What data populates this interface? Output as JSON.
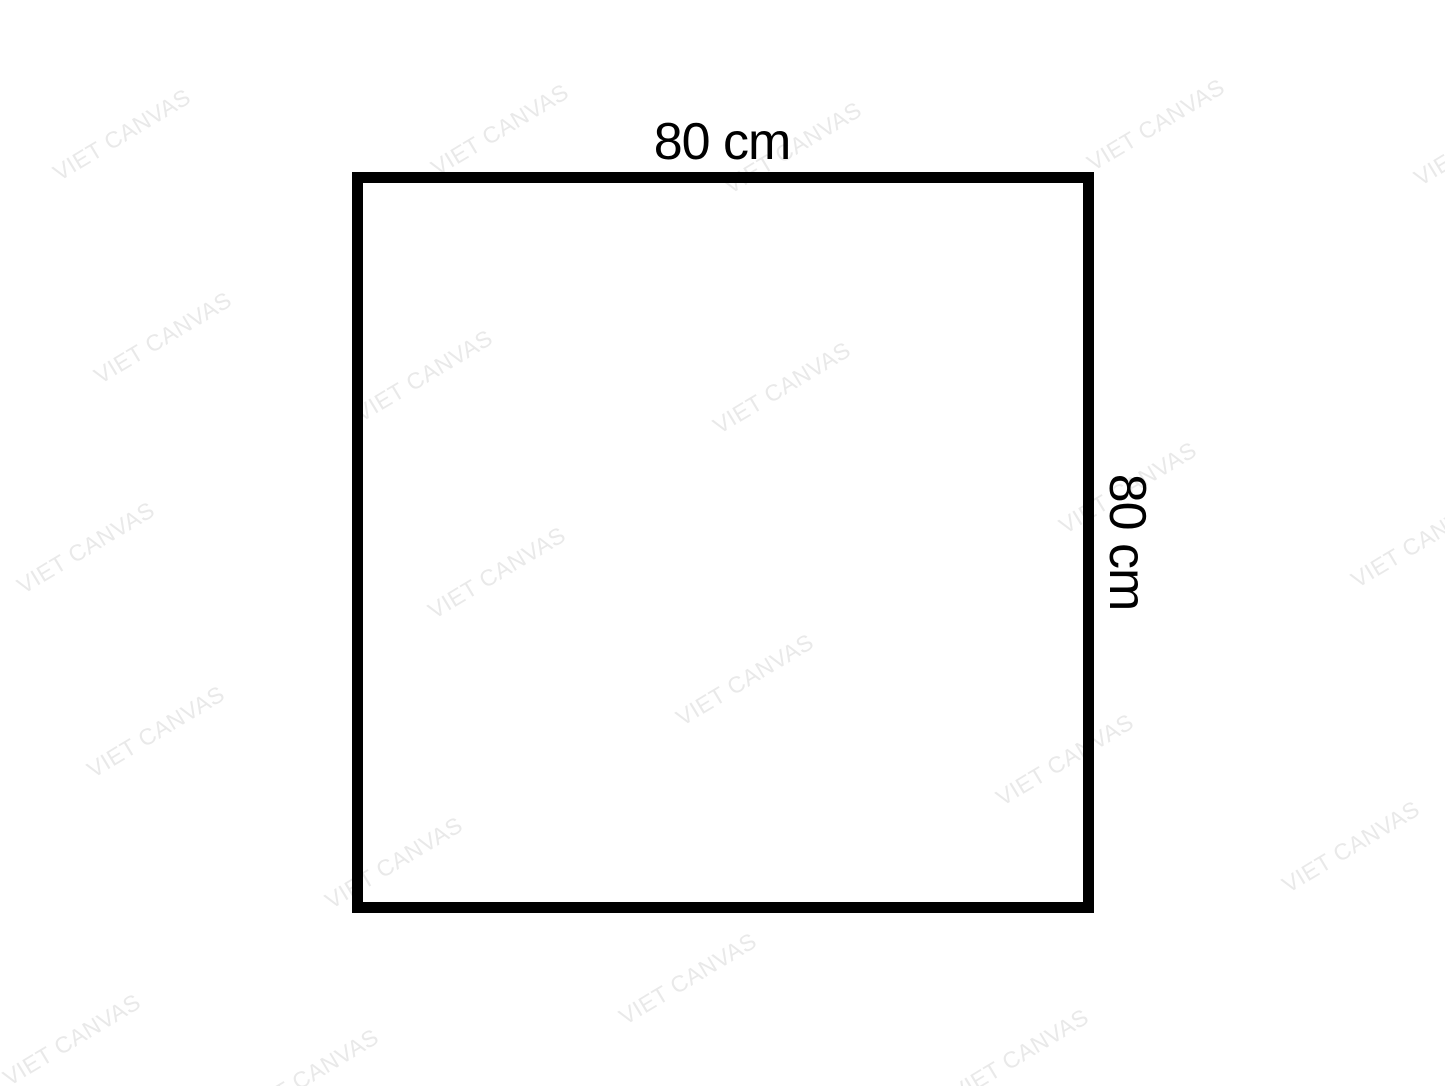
{
  "diagram": {
    "shape": "square",
    "width_label": "80 cm",
    "height_label": "80 cm"
  },
  "watermark": {
    "text": "VIET CANVAS",
    "color": "#e9e9e9",
    "angle_deg": -31,
    "positions": [
      {
        "x": 122,
        "y": 135
      },
      {
        "x": 500,
        "y": 130
      },
      {
        "x": 793,
        "y": 148
      },
      {
        "x": 1156,
        "y": 125
      },
      {
        "x": 1483,
        "y": 140
      },
      {
        "x": 163,
        "y": 338
      },
      {
        "x": 424,
        "y": 376
      },
      {
        "x": 782,
        "y": 388
      },
      {
        "x": 1128,
        "y": 488
      },
      {
        "x": 86,
        "y": 548
      },
      {
        "x": 497,
        "y": 573
      },
      {
        "x": 1420,
        "y": 542
      },
      {
        "x": 745,
        "y": 680
      },
      {
        "x": 156,
        "y": 732
      },
      {
        "x": 1065,
        "y": 760
      },
      {
        "x": 394,
        "y": 863
      },
      {
        "x": 1351,
        "y": 847
      },
      {
        "x": 688,
        "y": 979
      },
      {
        "x": 72,
        "y": 1040
      },
      {
        "x": 310,
        "y": 1075
      },
      {
        "x": 1020,
        "y": 1055
      }
    ]
  },
  "colors": {
    "background": "#ffffff",
    "outline": "#000000",
    "label_text": "#000000"
  }
}
